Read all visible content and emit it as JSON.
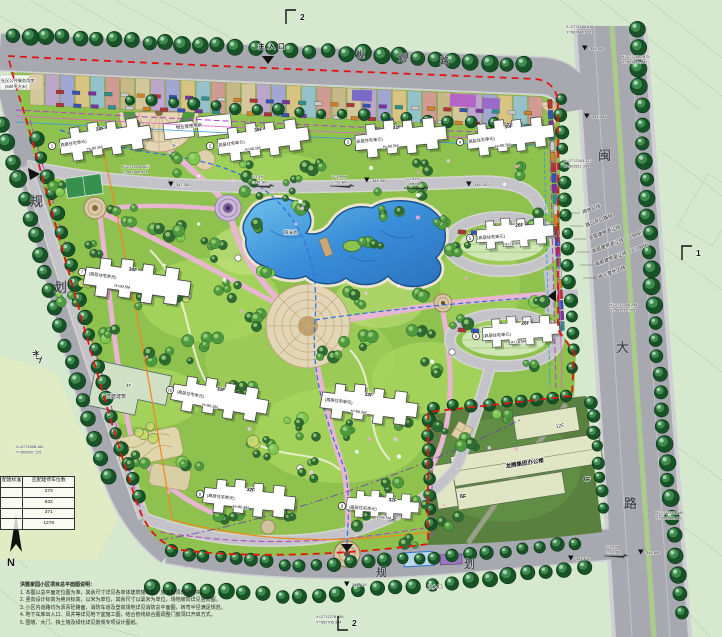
{
  "canvas": {
    "width": 722,
    "height": 637
  },
  "palette": {
    "boundary_red": "#e21414",
    "road_gray": "#a8a8b0",
    "site_green": "#8ec14e",
    "tree_dark": "#175327",
    "pool_blue": "#3a8ed8",
    "path_pink": "#e9b6d2",
    "setback_purple": "#b341c4",
    "utility_blue": "#2d6fe0",
    "utility_orange": "#f08a1d",
    "office_parcel_green": "#59803f"
  },
  "roads": {
    "top": {
      "name": "规划路",
      "size": 9,
      "chars": [
        {
          "ch": "规",
          "x": 356,
          "y": 58
        },
        {
          "ch": "划",
          "x": 398,
          "y": 61
        },
        {
          "ch": "路",
          "x": 440,
          "y": 64
        }
      ]
    },
    "left": {
      "name": "规划路",
      "size": 13,
      "chars": [
        {
          "ch": "规",
          "x": 30,
          "y": 206
        },
        {
          "ch": "划",
          "x": 54,
          "y": 292
        }
      ]
    },
    "bottom": {
      "name": "规划路",
      "size": 11,
      "chars": [
        {
          "ch": "规",
          "x": 376,
          "y": 576
        },
        {
          "ch": "划",
          "x": 464,
          "y": 568
        }
      ]
    },
    "right": {
      "name": "闽大路",
      "size": 13,
      "chars": [
        {
          "ch": "闽",
          "x": 598,
          "y": 160
        },
        {
          "ch": "大",
          "x": 616,
          "y": 352
        },
        {
          "ch": "路",
          "x": 624,
          "y": 508
        }
      ]
    }
  },
  "legend_lines": [
    "用地红线",
    "路口开口路段",
    "多层建筑退让线",
    "高层建筑退让线（＜80M）",
    "高层建筑退让线（＜100M）",
    "地下室外边线"
  ],
  "buildings": [
    {
      "no": "1",
      "floors": "30F",
      "type": "(高层住宅单元)",
      "height": "H=90.5M",
      "x": 52,
      "y": 146,
      "rot": -9,
      "s": 0.95
    },
    {
      "no": "2",
      "floors": "30F",
      "type": "(高层住宅单元)",
      "height": "H=90.5M",
      "x": 210,
      "y": 146,
      "rot": -8,
      "s": 0.95
    },
    {
      "no": "3",
      "floors": "32F",
      "type": "(高层住宅单元)",
      "height": "H=96.5M",
      "x": 348,
      "y": 142,
      "rot": -6,
      "s": 0.95
    },
    {
      "no": "4",
      "floors": "30F",
      "type": "(高层住宅单元)",
      "height": "H=90.5M",
      "x": 460,
      "y": 142,
      "rot": -7,
      "s": 0.9
    },
    {
      "no": "5",
      "floors": "26F",
      "type": "(高层住宅单元)",
      "height": "H=78.5M",
      "x": 470,
      "y": 238,
      "rot": -4,
      "s": 0.8
    },
    {
      "no": "6",
      "floors": "26F",
      "type": "(高层住宅单元)",
      "height": "H=78.5M",
      "x": 476,
      "y": 336,
      "rot": -4,
      "s": 0.8
    },
    {
      "no": "7",
      "floors": "30F",
      "type": "(高层住宅单元)",
      "height": "H=90.5M",
      "x": 82,
      "y": 272,
      "rot": 8,
      "s": 1.1
    },
    {
      "no": "10",
      "floors": "32F",
      "type": "(高层住宅单元)",
      "height": "H=96.5M",
      "x": 170,
      "y": 390,
      "rot": 10,
      "s": 1.0
    },
    {
      "no": "",
      "floors": "32F",
      "type": "(高层住宅单元)",
      "height": "H=96.5M",
      "x": 318,
      "y": 398,
      "rot": 7,
      "s": 1.0
    },
    {
      "no": "9",
      "floors": "32F",
      "type": "(高层住宅单元)",
      "height": "H=96.5M",
      "x": 200,
      "y": 494,
      "rot": 6,
      "s": 0.95
    },
    {
      "no": "8",
      "floors": "32F",
      "type": "(高层住宅单元)",
      "height": "H=96.5M",
      "x": 342,
      "y": 506,
      "rot": 4,
      "s": 0.75
    }
  ],
  "site_labels": [
    {
      "t": "主入口",
      "x": 258,
      "y": 49,
      "s": 7,
      "rot": -1,
      "b": true,
      "ls": 3
    },
    {
      "t": "次入口",
      "x": 428,
      "y": 589,
      "s": 5,
      "rot": -3
    },
    {
      "t": "水入",
      "x": 32,
      "y": 352,
      "s": 7,
      "rot": 55,
      "b": true
    },
    {
      "t": "物业管理用房",
      "x": 176,
      "y": 129,
      "s": 4.4,
      "rot": -6
    },
    {
      "t": "1F",
      "x": 172,
      "y": 147,
      "s": 4.2,
      "rot": -6
    },
    {
      "t": "游泳池",
      "x": 284,
      "y": 234,
      "s": 4.4,
      "rot": 0
    },
    {
      "t": "4F",
      "x": 126,
      "y": 387,
      "s": 4.6,
      "rot": 0
    },
    {
      "t": "已建建筑",
      "x": 106,
      "y": 398,
      "s": 5,
      "rot": 0
    },
    {
      "t": "社区公共服务用房",
      "x": 1,
      "y": 82,
      "s": 4.2,
      "rot": 0
    },
    {
      "t": "(600平方米)",
      "x": 5,
      "y": 88,
      "s": 4.2,
      "rot": 0
    },
    {
      "t": "龙腾集团办公楼",
      "x": 506,
      "y": 468,
      "s": 5.5,
      "rot": -9,
      "b": true
    },
    {
      "t": "12F",
      "x": 556,
      "y": 428,
      "s": 5,
      "rot": -9
    },
    {
      "t": "6F",
      "x": 584,
      "y": 481,
      "s": 5.5,
      "rot": 0,
      "b": true
    },
    {
      "t": "6F",
      "x": 460,
      "y": 498,
      "s": 5.5,
      "rot": 0,
      "b": true
    },
    {
      "t": "N",
      "x": 7,
      "y": 566,
      "s": 11,
      "rot": 0,
      "b": true
    }
  ],
  "coordinates": [
    {
      "xl": "X=2772780.616",
      "yl": "Y=502480.832",
      "x": 566,
      "y": 28
    },
    {
      "xl": "X=2772582.875",
      "yl": "Y=502853.342",
      "x": 622,
      "y": 58
    },
    {
      "xl": "X=2772343.227",
      "yl": "Y=502811.354",
      "x": 564,
      "y": 162
    },
    {
      "xl": "X=2772344.284",
      "yl": "Y=502616.705",
      "x": 610,
      "y": 306
    },
    {
      "xl": "X=2772534.625",
      "yl": "Y=502384.551",
      "x": 122,
      "y": 168
    },
    {
      "xl": "X=2772398.162",
      "yl": "Y=502597.125",
      "x": 16,
      "y": 448
    },
    {
      "xl": "X=2772278.385",
      "yl": "Y=502708.384",
      "x": 316,
      "y": 618
    },
    {
      "xl": "X=2772143.180",
      "yl": "Y=502685.646",
      "x": 656,
      "y": 514
    }
  ],
  "elevations": [
    {
      "v": "348.000",
      "x": 590,
      "y": 50
    },
    {
      "v": "344.045",
      "x": 592,
      "y": 118
    },
    {
      "v": "347.300",
      "x": 176,
      "y": 186
    },
    {
      "v": "346.300",
      "x": 372,
      "y": 182
    },
    {
      "v": "346.100",
      "x": 474,
      "y": 186
    },
    {
      "v": "346.415",
      "x": 352,
      "y": 586
    },
    {
      "v": "345.610",
      "x": 576,
      "y": 560
    },
    {
      "v": "346.690",
      "x": 646,
      "y": 554
    }
  ],
  "slopes": [
    {
      "i": "i=3.3%",
      "l": "L=34.3M",
      "x": 252,
      "y": 178
    },
    {
      "i": "i=-3.99%",
      "l": "L=92.6M",
      "x": 332,
      "y": 178
    },
    {
      "i": "i=1.91%",
      "l": "L=95.0M",
      "x": 406,
      "y": 180
    },
    {
      "i": "i=1.0%",
      "l": "L=92.6M",
      "x": 606,
      "y": 548
    }
  ],
  "section_markers": [
    {
      "label": "2",
      "x": 300,
      "y": 16,
      "dir": "up"
    },
    {
      "label": "2",
      "x": 352,
      "y": 624,
      "dir": "down"
    },
    {
      "label": "1",
      "x": 696,
      "y": 252,
      "dir": "up"
    }
  ],
  "table": {
    "headers": [
      "配建标准",
      "应配建停车位数"
    ],
    "rows": [
      [
        "",
        "273"
      ],
      [
        "",
        "632"
      ],
      [
        "",
        "371"
      ],
      [
        "",
        "1276"
      ]
    ]
  },
  "notes": {
    "title": "洪雅家园小区项目总平面图说明：",
    "items": [
      "1. 本图以总平面定位图为准，其余尺寸详见各单体建筑施工图，施工前须现场核实。",
      "2. 竖向设计标高为绝对标高，以米为单位，其余尺寸以毫米为单位，场地坡向详见竖向图。",
      "3. 小区内道路均为沥青砼路面，消防车道及登高场地详见消防总平面图，转弯半径满足规范。",
      "4. 地下车库出入口、风井等详见地下室施工图，结合管线综合图调整门窗洞口开启方式。",
      "5. 围墙、大门、挡土墙及绿化详见景观专项设计图纸。"
    ]
  }
}
